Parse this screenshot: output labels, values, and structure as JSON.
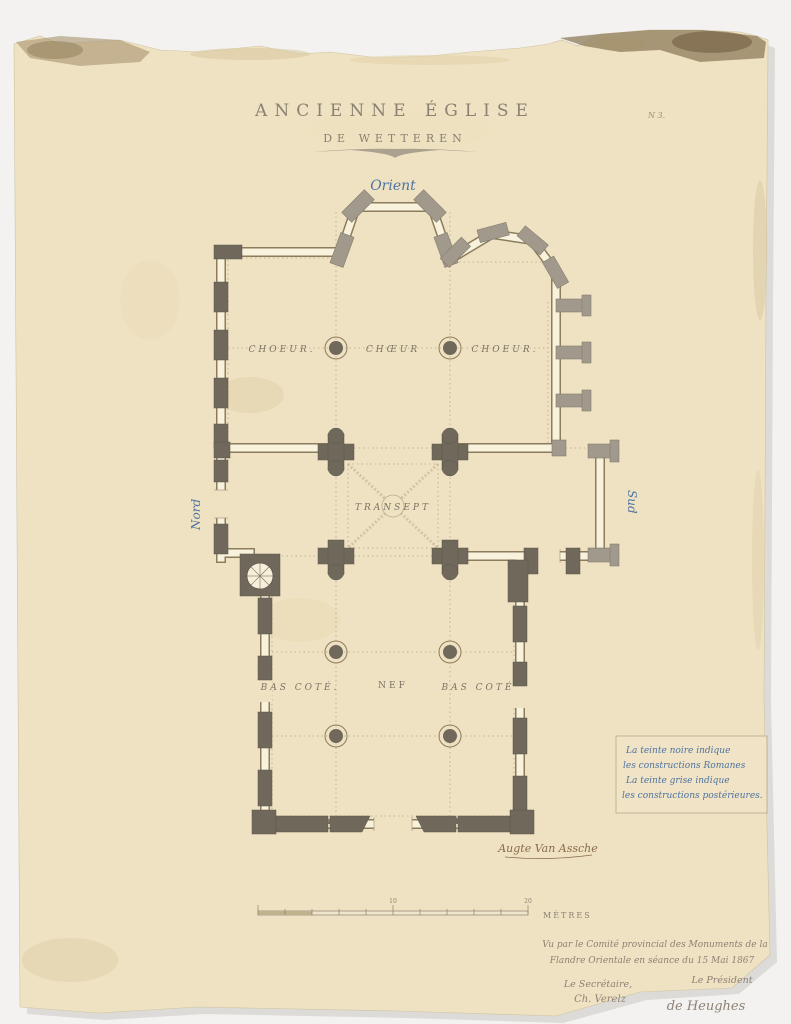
{
  "page": {
    "title_line1": "ANCIENNE ÉGLISE",
    "title_line2": "DE WETTEREN",
    "plate_no": "N 3."
  },
  "plan": {
    "orient": "Orient",
    "nord": "Nord",
    "sud": "Sud",
    "choeur_left": "CHOEUR.",
    "choeur_center": "CHŒUR",
    "choeur_right": "CHOEUR.",
    "transept": "TRANSEPT",
    "bas_cote_left": "BAS COTÉ.",
    "nef": "NEF",
    "bas_cote_right": "BAS COTÉ"
  },
  "legend": {
    "line1": "La teinte noire indique",
    "line2": "les constructions Romanes",
    "line3": "La teinte grise indique",
    "line4": "les constructions postérieures."
  },
  "signature_architect": "Augte Van Assche",
  "scale_bar": {
    "tick_10": "10",
    "tick_20": "20",
    "unit": "MÈTRES"
  },
  "approval": {
    "line1": "Vu par le Comité provincial des Monuments de la",
    "line2": "Flandre Orientale en séance du 15 Mai 1867",
    "secretary_title": "Le Secrétaire,",
    "president_title": "Le Président",
    "secretary_signature": "Ch. Verelz",
    "president_signature": "de Heughes"
  },
  "colors": {
    "paper": "#efe2c2",
    "tint_noire": "#6f685b",
    "tint_grise": "#a19a8c",
    "wall_line": "#8b7c5c",
    "ink_blue": "#4d74a0",
    "ink_brown": "#8a6b4a",
    "pencil": "#8d8176"
  }
}
